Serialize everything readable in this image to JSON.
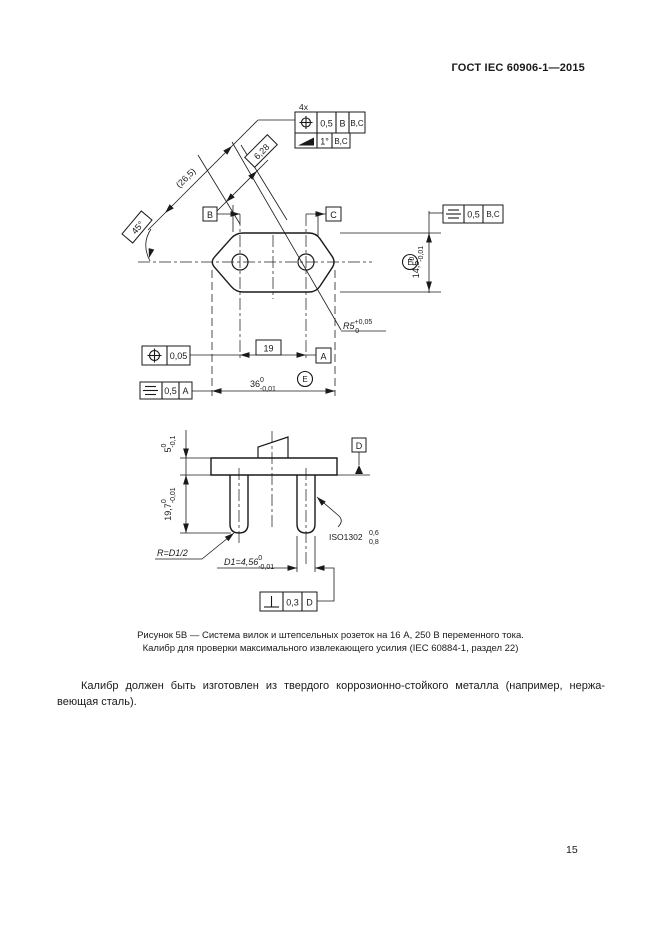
{
  "header": {
    "title": "ГОСТ IEC 60906-1—2015"
  },
  "page_number": "15",
  "figure": {
    "count_note": "4x",
    "datum_a": "A",
    "datum_b": "B",
    "datum_c": "C",
    "datum_d": "D",
    "envelope_symbol": "E",
    "fcf_position_top": {
      "tolerance": "0,5",
      "datum1": "B",
      "datum2": "B,C"
    },
    "fcf_slope_top": {
      "tolerance": "1°",
      "datum": "B,C"
    },
    "fcf_symmetry_right": {
      "tolerance": "0,5",
      "datum": "B,C"
    },
    "fcf_position_left": {
      "tolerance": "0,05"
    },
    "fcf_symmetry_left": {
      "tolerance": "0,5",
      "datum": "A"
    },
    "fcf_perpendicularity_bottom": {
      "tolerance": "0,3",
      "datum": "D"
    },
    "dim_diag_ref": "(26,5)",
    "dim_diag_boxed": "6,28",
    "dim_angle": "45°",
    "dim_hole_spacing": "19",
    "dim_width": {
      "main": "36",
      "sup": "0",
      "sub": "-0,01"
    },
    "dim_height": {
      "main": "14,5",
      "sup": "0",
      "sub": "-0,01"
    },
    "dim_corner_radius": {
      "main": "R5",
      "sup": "+0,05",
      "sub": "0"
    },
    "dim_plate_thickness": {
      "main": "5",
      "sup": "0",
      "sub": "-0,1"
    },
    "dim_pin_length": {
      "main": "19,7",
      "sup": "0",
      "sub": "-0,01"
    },
    "dim_pin_diameter": {
      "main": "D1=4,56",
      "sup": "0",
      "sub": "-0,01"
    },
    "note_pin_tip_radius": "R=D1/2",
    "note_surface_finish": {
      "main": "ISO1302",
      "upper": "0,6",
      "lower": "0,8"
    },
    "caption_line1": "Рисунок 5В — Система вилок и штепсельных розеток на 16 А, 250 В переменного тока.",
    "caption_line2": "Калибр для проверки максимального извлекающего усилия (IEC 60884-1, раздел 22)"
  },
  "body": {
    "paragraph_line1": "Калибр должен быть изготовлен из твердого коррозионно-стойкого металла (например, нержа-",
    "paragraph_line2": "веющая сталь)."
  }
}
